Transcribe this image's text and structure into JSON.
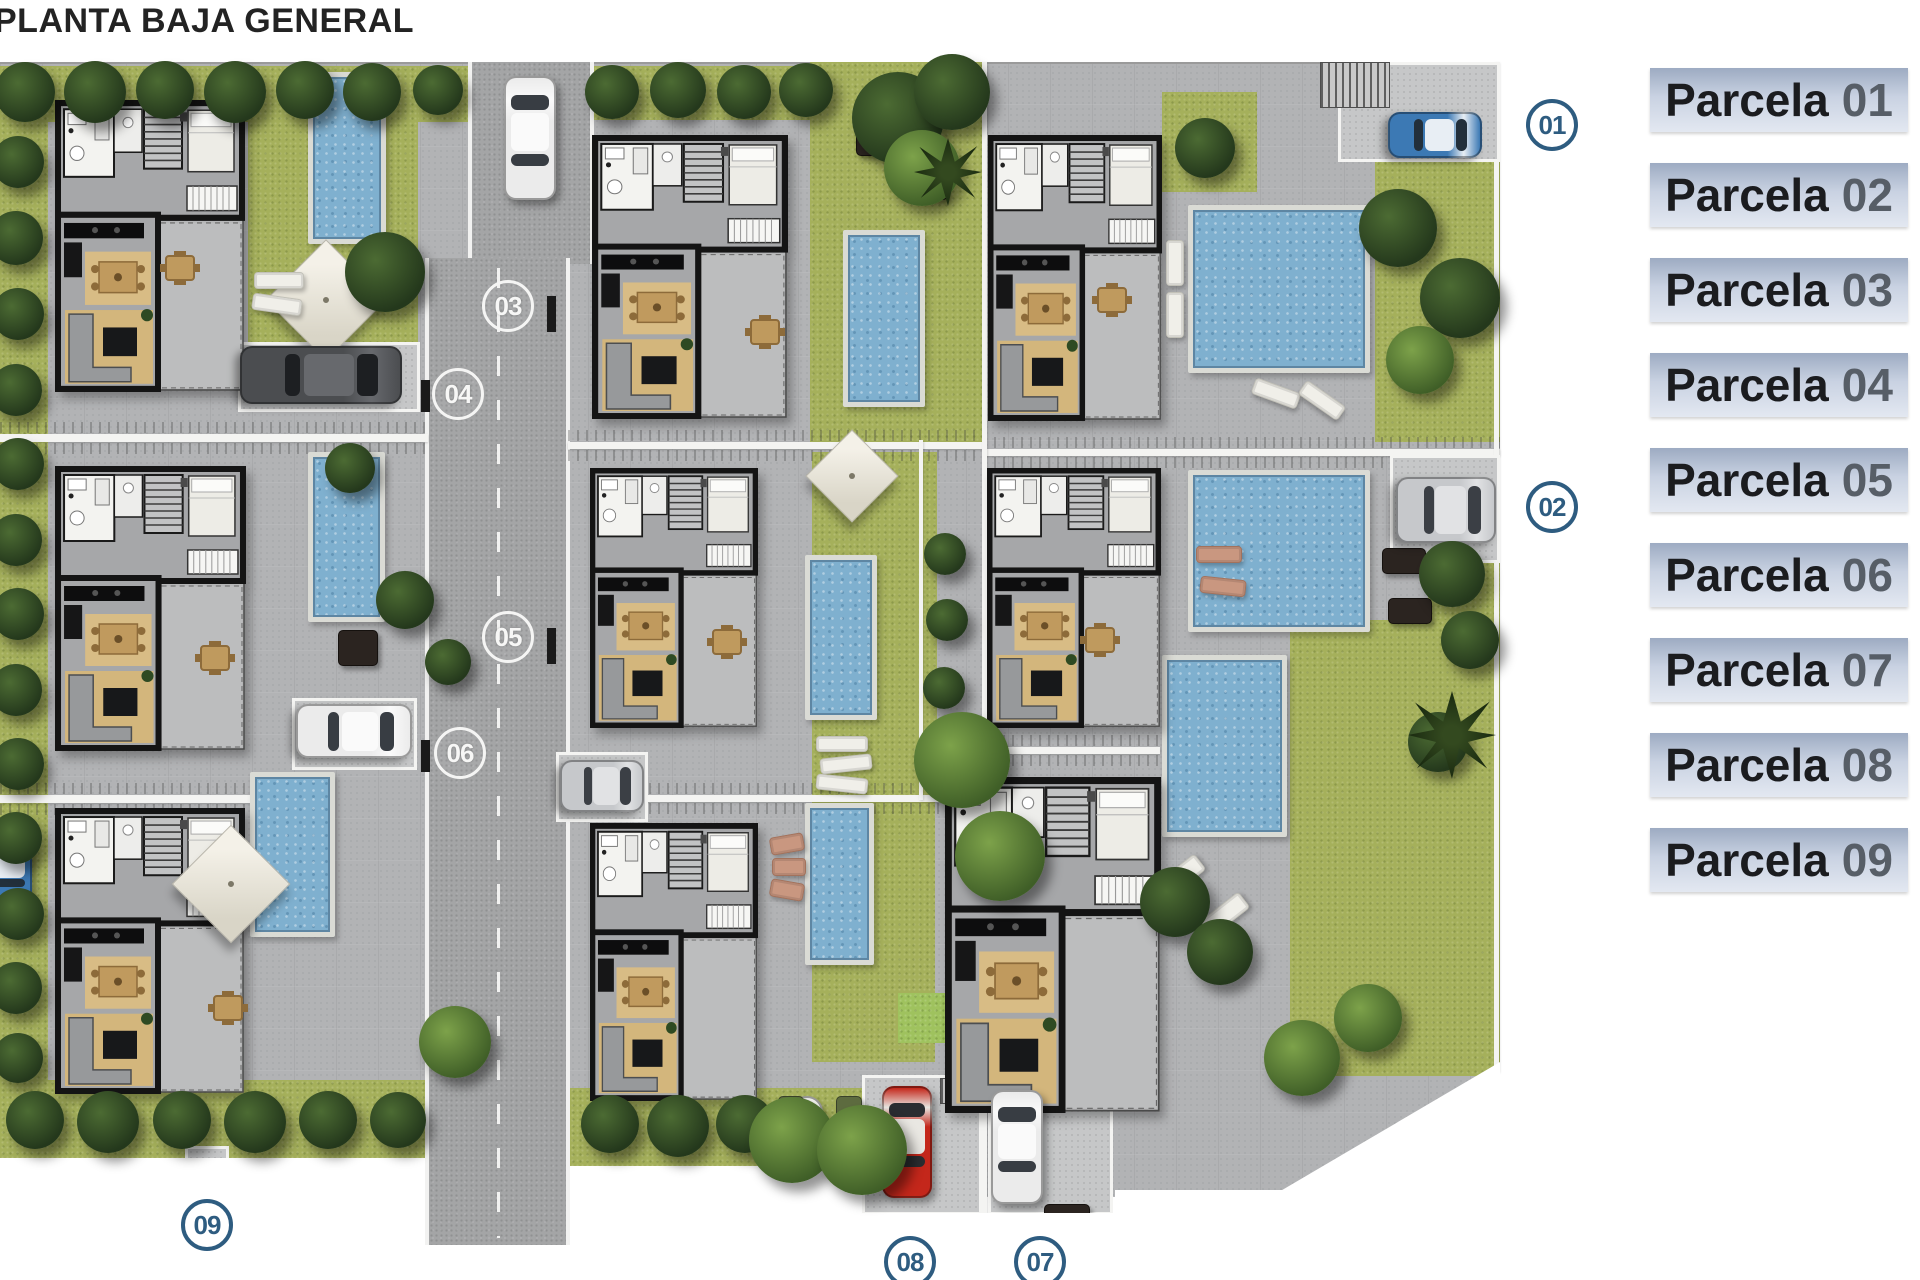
{
  "title": "PLANTA BAJA GENERAL",
  "legend": {
    "items": [
      {
        "name": "Parcela",
        "number": "01"
      },
      {
        "name": "Parcela",
        "number": "02"
      },
      {
        "name": "Parcela",
        "number": "03"
      },
      {
        "name": "Parcela",
        "number": "04"
      },
      {
        "name": "Parcela",
        "number": "05"
      },
      {
        "name": "Parcela",
        "number": "06"
      },
      {
        "name": "Parcela",
        "number": "07"
      },
      {
        "name": "Parcela",
        "number": "08"
      },
      {
        "name": "Parcela",
        "number": "09"
      }
    ]
  },
  "markers": [
    {
      "id": "01",
      "x": 1552,
      "y": 125,
      "style": "blue"
    },
    {
      "id": "02",
      "x": 1552,
      "y": 507,
      "style": "blue"
    },
    {
      "id": "03",
      "x": 508,
      "y": 306,
      "style": "white"
    },
    {
      "id": "04",
      "x": 458,
      "y": 394,
      "style": "white"
    },
    {
      "id": "05",
      "x": 508,
      "y": 637,
      "style": "white"
    },
    {
      "id": "06",
      "x": 460,
      "y": 753,
      "style": "white"
    },
    {
      "id": "07",
      "x": 1040,
      "y": 1262,
      "style": "blue"
    },
    {
      "id": "08",
      "x": 910,
      "y": 1262,
      "style": "blue"
    },
    {
      "id": "09",
      "x": 207,
      "y": 1225,
      "style": "blue"
    }
  ],
  "colors": {
    "marker_blue": "#2e5c80",
    "road": "#a4a5a6",
    "paving": "#b2b3b5",
    "grass": "#a5b05b",
    "grass_bright": "#9fc25e",
    "pool_water": "#7fb0cf",
    "legend_top": "#9dabc2",
    "legend_bottom": "#e3e8f1",
    "wall_white": "#f4f4f2",
    "cars": {
      "white": {
        "body": "#ebebeb",
        "roof": "#fafafa",
        "glass": "#383d43"
      },
      "dark": {
        "body": "#4b4d50",
        "roof": "#67696d",
        "glass": "#1d1f22"
      },
      "silver": {
        "body": "#c6c8cb",
        "roof": "#e1e2e4",
        "glass": "#3b3f45"
      },
      "blue": {
        "body": "#3c79b4",
        "roof": "#e8eef4",
        "glass": "#222f3b"
      },
      "red": {
        "body": "#c4271b",
        "roof": "#e9e7e2",
        "glass": "#2a2d31"
      }
    }
  },
  "plan": {
    "base": [
      0,
      62,
      1500,
      1135
    ],
    "roads": [
      [
        468,
        62,
        126,
        202
      ],
      [
        425,
        258,
        145,
        987
      ]
    ],
    "road_dash": {
      "x": 497,
      "y1": 268,
      "y2": 1238
    },
    "gates": [
      [
        547,
        296,
        9,
        36
      ],
      [
        547,
        628,
        9,
        36
      ],
      [
        421,
        380,
        9,
        32
      ],
      [
        421,
        740,
        9,
        32
      ]
    ],
    "grass": [
      [
        0,
        66,
        470,
        56,
        "base"
      ],
      [
        588,
        66,
        270,
        54,
        "base"
      ],
      [
        0,
        66,
        48,
        1090,
        "base"
      ],
      [
        0,
        1080,
        430,
        78,
        "base"
      ],
      [
        570,
        1088,
        292,
        78,
        "base"
      ],
      [
        248,
        66,
        170,
        280,
        "base"
      ],
      [
        810,
        62,
        172,
        380,
        "base"
      ],
      [
        812,
        452,
        125,
        343,
        "base"
      ],
      [
        812,
        802,
        123,
        260,
        "base"
      ],
      [
        1375,
        160,
        125,
        282,
        "base"
      ],
      [
        1428,
        540,
        72,
        122,
        "base"
      ],
      [
        1290,
        620,
        210,
        456,
        "base"
      ],
      [
        1162,
        92,
        95,
        100,
        "base"
      ],
      [
        898,
        993,
        54,
        50,
        "bright"
      ]
    ],
    "dividers": [
      [
        0,
        434,
        428,
        8
      ],
      [
        0,
        795,
        250,
        8
      ],
      [
        568,
        442,
        417,
        7
      ],
      [
        568,
        795,
        417,
        7
      ],
      [
        985,
        449,
        515,
        7
      ],
      [
        985,
        747,
        175,
        7
      ]
    ],
    "vlines": [
      [
        982,
        62,
        5,
        1151
      ],
      [
        919,
        440,
        4,
        360
      ],
      [
        1494,
        62,
        5,
        1010
      ]
    ],
    "pads": [
      [
        238,
        342,
        182,
        70
      ],
      [
        292,
        698,
        125,
        72
      ],
      [
        556,
        752,
        92,
        70
      ],
      [
        1338,
        62,
        162,
        100
      ],
      [
        1390,
        455,
        110,
        108
      ],
      [
        862,
        1075,
        120,
        140
      ],
      [
        988,
        1075,
        125,
        140
      ],
      [
        185,
        1146,
        44,
        40
      ]
    ],
    "hatches": [
      [
        1320,
        62,
        70,
        46
      ],
      [
        940,
        1078,
        28,
        26
      ]
    ],
    "pools": [
      [
        308,
        72,
        78,
        172
      ],
      [
        843,
        230,
        82,
        177
      ],
      [
        1188,
        205,
        182,
        168
      ],
      [
        308,
        452,
        77,
        170
      ],
      [
        805,
        555,
        72,
        165
      ],
      [
        1188,
        470,
        182,
        162
      ],
      [
        250,
        772,
        85,
        165
      ],
      [
        805,
        803,
        69,
        162
      ],
      [
        1162,
        655,
        125,
        182
      ]
    ],
    "houses": [
      [
        55,
        100,
        190,
        292
      ],
      [
        592,
        135,
        196,
        284
      ],
      [
        988,
        135,
        174,
        286
      ],
      [
        55,
        466,
        191,
        285
      ],
      [
        590,
        468,
        168,
        260
      ],
      [
        987,
        468,
        174,
        260
      ],
      [
        55,
        808,
        190,
        286
      ],
      [
        590,
        823,
        168,
        278
      ],
      [
        945,
        777,
        216,
        336
      ]
    ],
    "tables": [
      [
        180,
        268
      ],
      [
        765,
        332
      ],
      [
        215,
        658
      ],
      [
        727,
        642
      ],
      [
        1100,
        640
      ],
      [
        228,
        1008
      ],
      [
        1112,
        300
      ]
    ],
    "round_tables": [
      [
        807,
        1112
      ]
    ],
    "planters": [
      [
        856,
        132,
        34,
        24,
        "dark"
      ],
      [
        920,
        180,
        28,
        20,
        "dark"
      ],
      [
        1382,
        548,
        44,
        26,
        "dark"
      ],
      [
        1388,
        598,
        44,
        26,
        "dark"
      ],
      [
        778,
        1096,
        26,
        40,
        "olive"
      ],
      [
        836,
        1096,
        26,
        40,
        "olive"
      ],
      [
        1044,
        1204,
        46,
        18,
        "dark"
      ],
      [
        338,
        630,
        40,
        36,
        "dark"
      ]
    ],
    "parasols": [
      [
        326,
        300,
        86
      ],
      [
        852,
        476,
        66
      ],
      [
        231,
        884,
        84
      ]
    ],
    "loungers": [
      [
        254,
        272,
        50,
        17,
        0,
        "w"
      ],
      [
        252,
        296,
        50,
        17,
        8,
        "w"
      ],
      [
        816,
        736,
        52,
        16,
        0,
        "w"
      ],
      [
        820,
        756,
        52,
        16,
        -6,
        "w"
      ],
      [
        816,
        776,
        52,
        16,
        6,
        "w"
      ],
      [
        770,
        835,
        34,
        18,
        -10,
        "t"
      ],
      [
        772,
        858,
        34,
        18,
        0,
        "t"
      ],
      [
        770,
        881,
        34,
        18,
        10,
        "t"
      ],
      [
        1196,
        546,
        46,
        17,
        0,
        "t"
      ],
      [
        1200,
        578,
        46,
        17,
        6,
        "t"
      ],
      [
        1152,
        868,
        54,
        20,
        -38,
        "w"
      ],
      [
        1196,
        906,
        54,
        20,
        -38,
        "w"
      ],
      [
        1252,
        385,
        48,
        17,
        20,
        "w"
      ],
      [
        1298,
        392,
        48,
        17,
        35,
        "w"
      ],
      [
        1166,
        240,
        18,
        46,
        0,
        "w"
      ],
      [
        1166,
        292,
        18,
        46,
        0,
        "w"
      ]
    ],
    "cars": [
      [
        504,
        76,
        52,
        124,
        "white"
      ],
      [
        240,
        346,
        162,
        58,
        "dark"
      ],
      [
        296,
        704,
        116,
        54,
        "white"
      ],
      [
        560,
        760,
        84,
        52,
        "silver"
      ],
      [
        -22,
        832,
        54,
        76,
        "blue"
      ],
      [
        1388,
        112,
        94,
        46,
        "blue"
      ],
      [
        1396,
        477,
        100,
        66,
        "silver"
      ],
      [
        882,
        1086,
        50,
        112,
        "red"
      ],
      [
        991,
        1090,
        52,
        114,
        "white"
      ]
    ],
    "trees": [
      [
        25,
        92,
        30,
        "d"
      ],
      [
        95,
        92,
        31,
        "d"
      ],
      [
        165,
        90,
        29,
        "d"
      ],
      [
        235,
        92,
        31,
        "d"
      ],
      [
        305,
        90,
        29,
        "d"
      ],
      [
        372,
        92,
        29,
        "d"
      ],
      [
        438,
        90,
        25,
        "d"
      ],
      [
        612,
        92,
        27,
        "d"
      ],
      [
        678,
        90,
        28,
        "d"
      ],
      [
        744,
        92,
        27,
        "d"
      ],
      [
        806,
        90,
        27,
        "d"
      ],
      [
        898,
        118,
        46,
        "d"
      ],
      [
        952,
        92,
        38,
        "d"
      ],
      [
        922,
        168,
        38,
        "g"
      ],
      [
        948,
        172,
        34,
        "p"
      ],
      [
        385,
        272,
        40,
        "d"
      ],
      [
        18,
        162,
        26,
        "d"
      ],
      [
        16,
        238,
        27,
        "d"
      ],
      [
        18,
        314,
        26,
        "d"
      ],
      [
        16,
        390,
        26,
        "d"
      ],
      [
        18,
        464,
        26,
        "d"
      ],
      [
        16,
        540,
        26,
        "d"
      ],
      [
        18,
        614,
        26,
        "d"
      ],
      [
        16,
        690,
        26,
        "d"
      ],
      [
        18,
        764,
        26,
        "d"
      ],
      [
        16,
        838,
        26,
        "d"
      ],
      [
        18,
        914,
        26,
        "d"
      ],
      [
        16,
        988,
        26,
        "d"
      ],
      [
        18,
        1058,
        25,
        "d"
      ],
      [
        35,
        1120,
        29,
        "d"
      ],
      [
        108,
        1122,
        31,
        "d"
      ],
      [
        182,
        1120,
        29,
        "d"
      ],
      [
        255,
        1122,
        31,
        "d"
      ],
      [
        328,
        1120,
        29,
        "d"
      ],
      [
        398,
        1120,
        28,
        "d"
      ],
      [
        610,
        1124,
        29,
        "d"
      ],
      [
        678,
        1126,
        31,
        "d"
      ],
      [
        745,
        1124,
        29,
        "d"
      ],
      [
        792,
        1140,
        43,
        "g"
      ],
      [
        862,
        1150,
        45,
        "g"
      ],
      [
        455,
        1042,
        36,
        "g"
      ],
      [
        350,
        468,
        25,
        "d"
      ],
      [
        405,
        600,
        29,
        "d"
      ],
      [
        448,
        662,
        23,
        "d"
      ],
      [
        945,
        554,
        21,
        "d"
      ],
      [
        947,
        620,
        21,
        "d"
      ],
      [
        944,
        688,
        21,
        "d"
      ],
      [
        947,
        754,
        21,
        "d"
      ],
      [
        962,
        760,
        48,
        "g"
      ],
      [
        1000,
        856,
        45,
        "g"
      ],
      [
        1205,
        148,
        30,
        "d"
      ],
      [
        1398,
        228,
        39,
        "d"
      ],
      [
        1460,
        298,
        40,
        "d"
      ],
      [
        1420,
        360,
        34,
        "g"
      ],
      [
        1452,
        574,
        33,
        "d"
      ],
      [
        1470,
        640,
        29,
        "d"
      ],
      [
        1438,
        742,
        30,
        "d"
      ],
      [
        1452,
        735,
        44,
        "p"
      ],
      [
        1175,
        902,
        35,
        "d"
      ],
      [
        1220,
        952,
        33,
        "d"
      ],
      [
        1302,
        1058,
        38,
        "g"
      ],
      [
        1368,
        1018,
        34,
        "g"
      ]
    ],
    "masks": [
      [
        0,
        1158,
        425,
        122
      ],
      [
        570,
        1166,
        292,
        114
      ],
      [
        862,
        1213,
        253,
        67
      ],
      [
        1115,
        1190,
        385,
        92
      ],
      [
        425,
        1245,
        145,
        35
      ]
    ],
    "corner_cut": [
      1272,
      1062,
      228,
      134
    ]
  }
}
